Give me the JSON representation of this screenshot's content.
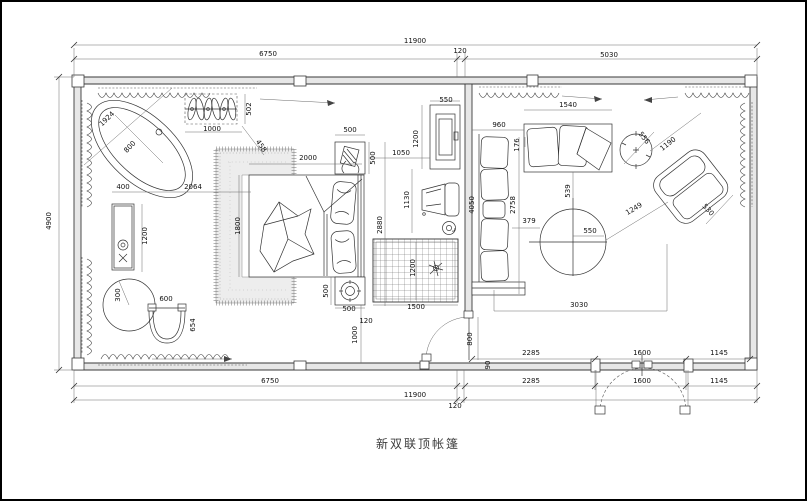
{
  "title": {
    "name": "新双联顶帐篷"
  },
  "dims": {
    "t_total": "11900",
    "t_a": "6750",
    "t_b": "120",
    "t_c": "5030",
    "left": "4900",
    "wa_a": "2285",
    "wa_b": "1600",
    "wa_c": "1145",
    "b_a": "6750",
    "b_b": "2285",
    "b_c": "1600",
    "b_d": "1145",
    "b_total": "11900",
    "b_gap": "120",
    "tub_l": "1924",
    "tub_w": "800",
    "rack_w": "1000",
    "rack_d": "502",
    "rack_off": "458",
    "van_w": "400",
    "van_gap": "2064",
    "van_h": "1200",
    "tbl_r": "300",
    "chair_w": "600",
    "chair_d": "654",
    "bed_l": "2000",
    "bed_w": "1800",
    "bed_side": "2880",
    "ns1_w": "500",
    "ns1_d": "500",
    "ns1_gap": "1050",
    "ns2_d": "500",
    "ns2_w": "500",
    "ns2_gap": "120",
    "ns2_off": "1000",
    "rug_w": "1500",
    "rug_d": "1200",
    "tv_w": "550",
    "tv_h": "1200",
    "ch2": "1130",
    "door_w": "800",
    "door_t": "90",
    "sofa_len": "4050",
    "sofa_clr": "2758",
    "sofa_top": "176",
    "st_gap": "960",
    "st_len": "1540",
    "st_tbl": "539",
    "side_tbl": "556",
    "ac_w": "1190",
    "ac_d": "530",
    "ac_gap": "1249",
    "rt_d": "550",
    "rt_gap": "379",
    "lv_w": "3030"
  }
}
